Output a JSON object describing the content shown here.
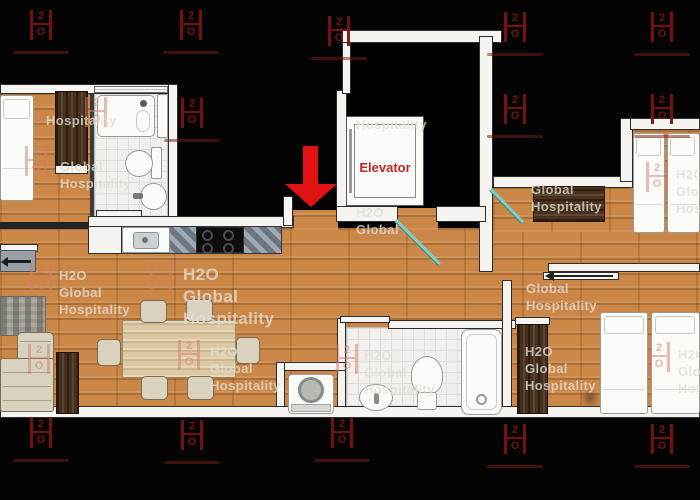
{
  "title": "Apartment floor plan with elevator",
  "elevator_label": "Elevator",
  "colors": {
    "background": "#000000",
    "wood_floor": "#cb8747",
    "wall": "#f5f4f1",
    "watermark_red": "#7d120e",
    "pale_watermark_text": "#d9d5cd",
    "door_teal": "#7ad1c9",
    "arrow_red": "#e11212",
    "elevator_label_red": "#c22527"
  },
  "watermark": {
    "glyph_top": "2",
    "glyph_bottom": "O",
    "brand_lines": [
      "H2O",
      "Global",
      "Hospitality"
    ],
    "dark_positions": [
      {
        "x": 30,
        "y": 10
      },
      {
        "x": 180,
        "y": 10
      },
      {
        "x": 328,
        "y": 16
      },
      {
        "x": 504,
        "y": 12
      },
      {
        "x": 651,
        "y": 12
      },
      {
        "x": 181,
        "y": 98
      },
      {
        "x": 504,
        "y": 94
      },
      {
        "x": 651,
        "y": 94
      },
      {
        "x": 30,
        "y": 418
      },
      {
        "x": 181,
        "y": 420
      },
      {
        "x": 331,
        "y": 418
      },
      {
        "x": 504,
        "y": 424
      },
      {
        "x": 651,
        "y": 424
      }
    ],
    "pale_instances": [
      {
        "x": 25,
        "y": 146,
        "logo": true,
        "tx": 60,
        "ty": 158,
        "lines": [
          "Global",
          "Hospitality"
        ]
      },
      {
        "x": 85,
        "y": 97,
        "logo": true,
        "lines": []
      },
      {
        "logo": false,
        "tx": 46,
        "ty": 112,
        "lines": [
          "Hospitality"
        ]
      },
      {
        "x": 30,
        "y": 264,
        "logo": true,
        "tx": 59,
        "ty": 267,
        "lines": [
          "H2O",
          "Global",
          "Hospitality"
        ]
      },
      {
        "x": 150,
        "y": 262,
        "logo": true,
        "tx": 183,
        "ty": 264,
        "size": 17,
        "lines": [
          "H2O",
          "Global",
          "Hospitality"
        ]
      },
      {
        "x": 178,
        "y": 340,
        "logo": true,
        "tx": 210,
        "ty": 343,
        "lines": [
          "H2O",
          "Global",
          "Hospitality"
        ]
      },
      {
        "x": 28,
        "y": 344,
        "logo": true,
        "lines": []
      },
      {
        "x": 336,
        "y": 344,
        "logo": true,
        "tx": 364,
        "ty": 347,
        "lines": [
          "H2O",
          "Global",
          "Hospitality"
        ]
      },
      {
        "logo": false,
        "tx": 356,
        "ty": 116,
        "lines": [
          "Hospitality"
        ]
      },
      {
        "logo": false,
        "tx": 356,
        "ty": 204,
        "lines": [
          "H2O",
          "Global"
        ]
      },
      {
        "logo": false,
        "tx": 531,
        "ty": 181,
        "lines": [
          "Global",
          "Hospitality"
        ]
      },
      {
        "x": 646,
        "y": 162,
        "logo": true,
        "tx": 676,
        "ty": 166,
        "lines": [
          "H2O",
          "Global",
          "Hospitality"
        ]
      },
      {
        "logo": false,
        "tx": 526,
        "ty": 280,
        "lines": [
          "Global",
          "Hospitality"
        ]
      },
      {
        "logo": false,
        "tx": 525,
        "ty": 343,
        "lines": [
          "H2O",
          "Global",
          "Hospitality"
        ]
      },
      {
        "x": 648,
        "y": 342,
        "logo": true,
        "tx": 678,
        "ty": 346,
        "lines": [
          "H2O",
          "Global",
          "Hospitality"
        ]
      }
    ]
  }
}
